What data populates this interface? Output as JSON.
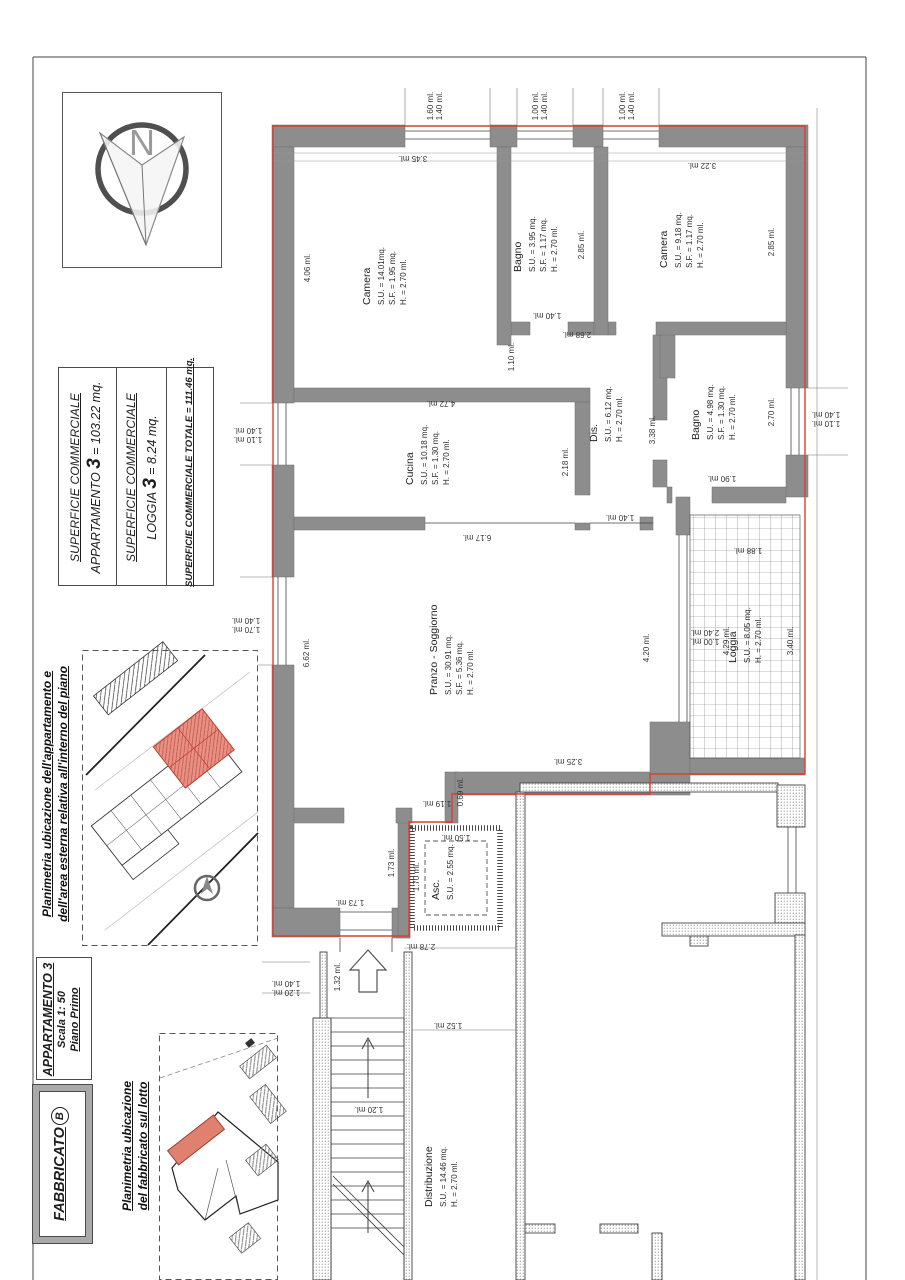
{
  "colors": {
    "wall": "#8d8d8d",
    "boundary": "#d8402f",
    "red_fill": "#e89184",
    "accent_red": "#c0392b"
  },
  "compass": {
    "letter": "N"
  },
  "title_block": {
    "s1_line1": "SUPERFICIE COMMERCIALE",
    "s1_pre": "APPARTAMENTO ",
    "s1_big": "3",
    "s1_post": " = 103.22 mq.",
    "s2_line1": "SUPERFICIE COMMERCIALE",
    "s2_pre": "LOGGIA ",
    "s2_big": "3",
    "s2_post": " = 8.24 mq.",
    "s3_line": "SUPERFICIE COMMERCIALE TOTALE = 111.46 mq."
  },
  "captions": {
    "piano_line1": "Planimetria ubicazione dell'appartamento e",
    "piano_line2": "dell'area esterna relativa all'interno del piano",
    "lotto_line1": "Planimetria ubicazione",
    "lotto_line2": "del fabbricato sul lotto"
  },
  "legend": {
    "apartment": "APPARTAMENTO 3",
    "scale": "Scala 1: 50",
    "floor": "Piano Primo",
    "building_word": "FABBRICATO",
    "building_letter": "B"
  },
  "rooms": [
    {
      "name": "Camera",
      "line1": "S.U. = 14.01mq.",
      "line2": "S.F. = 1.95 mq.",
      "line3": "H. = 2.70 ml."
    },
    {
      "name": "Bagno",
      "line1": "S.U. = 3.95 mq.",
      "line2": "S.F. = 1.17 mq.",
      "line3": "H. = 2.70 ml."
    },
    {
      "name": "Camera",
      "line1": "S.U. = 9.18 mq.",
      "line2": "S.F. = 1.17 mq.",
      "line3": "H. = 2.70 ml."
    },
    {
      "name": "Cucina",
      "line1": "S.U. = 10.18 mq.",
      "line2": "S.F. = 1.30 mq.",
      "line3": "H. = 2.70 ml."
    },
    {
      "name": "Dis.",
      "line1": "S.U. = 6.12 mq.",
      "line2": "H. = 2.70 ml."
    },
    {
      "name": "Bagno",
      "line1": "S.U. = 4.98 mq.",
      "line2": "S.F. = 1.30 mq.",
      "line3": "H. = 2.70 ml."
    },
    {
      "name": "Pranzo - Soggiorno",
      "line1": "S.U. = 30.91 mq.",
      "line2": "S.F. = 5.36 mq.",
      "line3": "H. = 2.70 ml."
    },
    {
      "name": "Loggia",
      "line1": "S.U. = 8.05 mq.",
      "line2": "H. = 2.70 ml."
    },
    {
      "name": "Asc.",
      "line1": "S.U. = 2.55 mq."
    },
    {
      "name": "Distribuzione",
      "line1": "S.U. = 14.46 mq.",
      "line2": "H. = 2.70 ml."
    }
  ],
  "dims": [
    "1.60 ml.",
    "1.40 ml.",
    "1.00 ml.",
    "1.40 ml.",
    "1.00 ml.",
    "1.40 ml.",
    "3.45 ml.",
    "4.06 ml.",
    "3.22 ml.",
    "2.85 ml.",
    "2.85 ml.",
    "1.40 ml.",
    "2.68 ml.",
    "1.10 ml.",
    "4.72 ml.",
    "2.18 ml.",
    "6.17 ml.",
    "3.38 ml.",
    "1.90 ml.",
    "2.70 ml.",
    "1.40 ml.",
    "1.10 ml.",
    "1.40 ml.",
    "1.10 ml.",
    "1.40 ml.",
    "1.70 ml.",
    "6.62 ml.",
    "1.40 ml.",
    "4.20 ml.",
    "2.40 ml.",
    "1.00 ml.",
    "4.29 ml.",
    "3.40 ml.",
    "1.88 ml.",
    "3.25 ml.",
    "0.69 ml.",
    "1.19 ml.",
    "1.73 ml.",
    "1.70 ml.",
    "1.50 ml.",
    "2.78 ml.",
    "1.73 ml.",
    "1.32 ml.",
    "1.40 ml.",
    "1.20 ml.",
    "1.52 ml.",
    "1.20 ml."
  ]
}
